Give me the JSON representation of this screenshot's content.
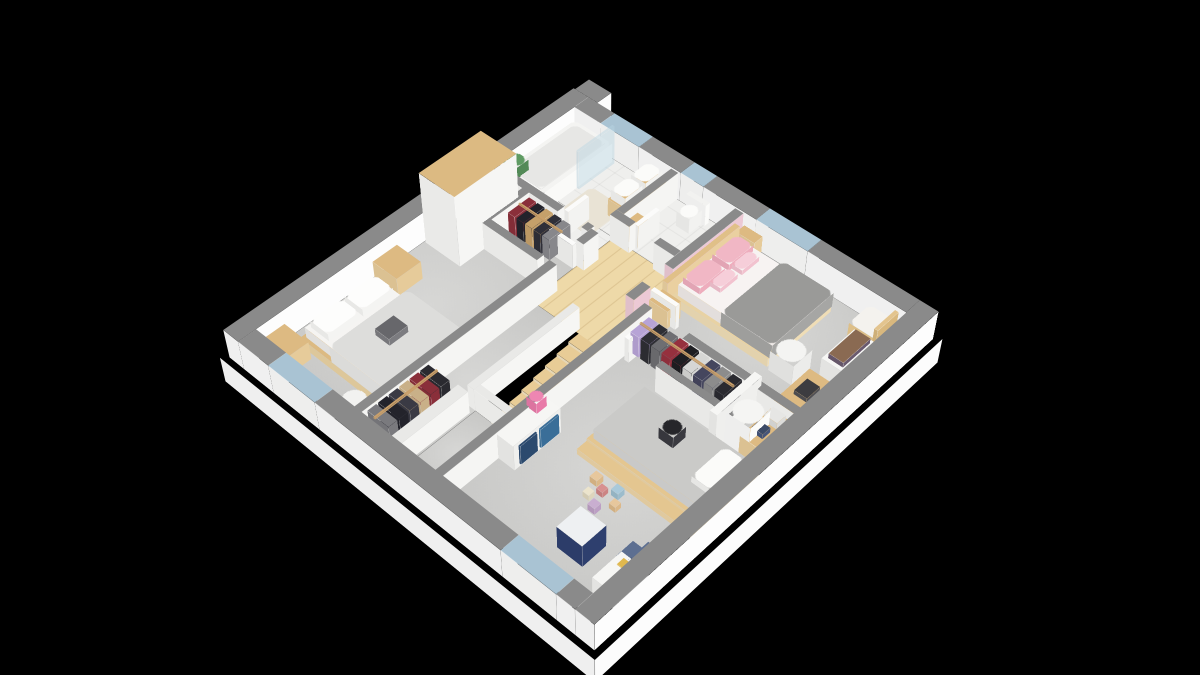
{
  "scene": {
    "background": "#000000",
    "description": "3D isometric floor plan render of a house upper storey",
    "camera": {
      "translate_x": 574,
      "translate_y": 116,
      "rotate_x_deg": 42,
      "rotate_z_deg": 43,
      "perspective_px": 1800
    },
    "palette": {
      "wall_top": "#8a8a8a",
      "wall_side": "#f5f5f3",
      "exterior_side": "#fdfdfd",
      "pink_wall": "#ecc9d5",
      "carpet": "#d2d2d0",
      "tile": "#efefed",
      "wood_floor": "#eed9a8",
      "wood_furniture": "#ddba82",
      "window_glass": "#a9c3d3",
      "gray_duvet": "#9a9a98",
      "kids_duvet": "#cacac8",
      "pink_textile": "#f1b7c5",
      "navy_toybox": "#2e3f6e",
      "blue_drawer": "#3a6e98",
      "glass": "rgba(185,212,226,0.45)"
    },
    "rooms": [
      {
        "name": "bathroom"
      },
      {
        "name": "wc"
      },
      {
        "name": "landing-with-stairs"
      },
      {
        "name": "bedroom-left"
      },
      {
        "name": "bedroom-pink"
      },
      {
        "name": "kids-bedroom"
      },
      {
        "name": "walk-in-closet-upper"
      },
      {
        "name": "walk-in-closet-lower"
      }
    ],
    "slab": [
      -6,
      -6,
      452,
      452,
      -32,
      0,
      "#fcfcfc"
    ],
    "floors": [
      [
        20,
        20,
        205,
        80,
        "tile"
      ],
      [
        20,
        100,
        126,
        30,
        "tile"
      ],
      [
        146,
        100,
        98,
        110,
        "wood"
      ],
      [
        20,
        130,
        126,
        290,
        "carpet"
      ],
      [
        225,
        20,
        195,
        150,
        "carpet"
      ],
      [
        244,
        170,
        176,
        250,
        "carpet"
      ],
      [
        146,
        210,
        56,
        210,
        "carpet"
      ],
      [
        202,
        335,
        42,
        85,
        "carpet"
      ]
    ],
    "walls": [
      [
        0,
        0,
        20,
        440,
        "ext"
      ],
      [
        20,
        0,
        35,
        20,
        "ext"
      ],
      [
        105,
        0,
        53,
        20,
        "ext"
      ],
      [
        186,
        0,
        64,
        20,
        "ext"
      ],
      [
        310,
        0,
        110,
        20,
        "ext"
      ],
      [
        420,
        0,
        20,
        440,
        "ext"
      ],
      [
        20,
        420,
        40,
        20,
        "ext"
      ],
      [
        120,
        420,
        220,
        20,
        "ext"
      ],
      [
        400,
        420,
        20,
        20,
        "ext"
      ],
      [
        2,
        -20,
        30,
        20,
        "ext"
      ],
      [
        55,
        0,
        50,
        20,
        "window"
      ],
      [
        158,
        0,
        28,
        20,
        "window"
      ],
      [
        250,
        0,
        60,
        20,
        "window"
      ],
      [
        60,
        420,
        60,
        20,
        "window"
      ],
      [
        340,
        420,
        60,
        20,
        "window"
      ],
      [
        20,
        126,
        88,
        9,
        "int"
      ],
      [
        138,
        126,
        8,
        9,
        "int"
      ],
      [
        146,
        20,
        9,
        76,
        "int"
      ],
      [
        146,
        96,
        24,
        9,
        "int"
      ],
      [
        200,
        96,
        25,
        9,
        "int"
      ],
      [
        146,
        130,
        9,
        20,
        "int"
      ],
      [
        146,
        185,
        9,
        235,
        "int"
      ],
      [
        244,
        166,
        9,
        254,
        "int"
      ],
      [
        296,
        166,
        124,
        9,
        "int"
      ],
      [
        300,
        206,
        84,
        8,
        "int"
      ],
      [
        62,
        130,
        9,
        60,
        "int"
      ],
      [
        62,
        184,
        76,
        9,
        "int"
      ],
      [
        225,
        20,
        10,
        98,
        "pink"
      ],
      [
        225,
        148,
        10,
        22,
        "pink"
      ],
      [
        194,
        205,
        8,
        130,
        "low"
      ],
      [
        202,
        327,
        42,
        8,
        "low"
      ],
      [
        188,
        340,
        12,
        80,
        "low"
      ],
      [
        108,
        98,
        5,
        28,
        "door"
      ],
      [
        168,
        66,
        5,
        30,
        "door"
      ],
      [
        116,
        150,
        30,
        5,
        "door"
      ],
      [
        235,
        143,
        30,
        5,
        "door"
      ],
      [
        256,
        175,
        5,
        30,
        "door"
      ]
    ],
    "stairs": {
      "x": 204,
      "y": 207,
      "width": 38,
      "step_depth": 15,
      "count": 8,
      "top_drop": 2,
      "drop_per_step": 3.6,
      "top": "#e8cc96",
      "side": "#f2e2c0"
    },
    "furniture": [
      [
        "bathtub",
        24,
        24,
        50,
        98,
        0,
        24,
        "#f4f4f2",
        "#fafaf8",
        1
      ],
      [
        "bathtub-inner",
        29,
        29,
        40,
        88,
        24,
        25,
        "#e7e7e5",
        "#e7e7e5",
        1
      ],
      [
        "shower-glass",
        74,
        24,
        3,
        50,
        0,
        48,
        "rgba(185,212,226,0.45)",
        "rgba(185,212,226,0.45)",
        0
      ],
      [
        "plant",
        24,
        106,
        18,
        16,
        20,
        38,
        "#5f9b63",
        "#538a57",
        2
      ],
      [
        "bath-mat",
        84,
        64,
        44,
        50,
        0,
        1,
        "#e9e3d5",
        "#e9e3d5",
        1
      ],
      [
        "vanity",
        122,
        24,
        22,
        58,
        0,
        22,
        "#ddba82",
        "#e6cb9a",
        0
      ],
      [
        "sink-1",
        124,
        28,
        18,
        24,
        22,
        34,
        "#fbfbf9",
        "#f3f3f1",
        1
      ],
      [
        "sink-2",
        124,
        56,
        18,
        24,
        22,
        34,
        "#fbfbf9",
        "#f3f3f1",
        1
      ],
      [
        "toilet-tank",
        174,
        24,
        24,
        6,
        0,
        26,
        "#f2f2f0",
        "#fbfbf9",
        0
      ],
      [
        "toilet-bowl",
        178,
        30,
        16,
        18,
        0,
        18,
        "#fbfbf9",
        "#f2f2f0",
        2
      ],
      [
        "wc-shelf",
        156,
        78,
        16,
        16,
        0,
        24,
        "#ddba82",
        "#e6cb9a",
        0
      ],
      [
        "wardrobe",
        22,
        146,
        46,
        78,
        0,
        88,
        "#dcba82",
        "#f6f6f4",
        0
      ],
      [
        "nightstand-1",
        22,
        258,
        32,
        30,
        0,
        22,
        "#ddba82",
        "#e6cb9a",
        0
      ],
      [
        "nightstand-2",
        22,
        392,
        32,
        30,
        0,
        22,
        "#ddba82",
        "#e6cb9a",
        0
      ],
      [
        "bed-frame",
        36,
        296,
        116,
        92,
        0,
        11,
        "#dcba82",
        "#e9d1a2",
        0
      ],
      [
        "bed-mattress",
        40,
        300,
        108,
        84,
        11,
        24,
        "#f5f4f2",
        "#ecebe9",
        0
      ],
      [
        "bed-duvet",
        78,
        296,
        72,
        92,
        11,
        32,
        "#dddddb",
        "#e6e6e4",
        1
      ],
      [
        "bed-pillow-1",
        44,
        304,
        24,
        36,
        24,
        33,
        "#fdfdfc",
        "#f4f4f2",
        1
      ],
      [
        "bed-pillow-2",
        44,
        344,
        24,
        36,
        24,
        33,
        "#fdfdfc",
        "#f4f4f2",
        1
      ],
      [
        "bed-books",
        98,
        330,
        18,
        22,
        32,
        40,
        "#67676b",
        "#7c7c80",
        0
      ],
      [
        "pouf",
        116,
        394,
        22,
        22,
        0,
        15,
        "#f2f2f0",
        "#fafaf8",
        2
      ],
      [
        "clothes-m1",
        74,
        138,
        9,
        28,
        6,
        32,
        "#8a2f3a",
        "#8a2f3a",
        0
      ],
      [
        "clothes-m2",
        85,
        138,
        9,
        28,
        6,
        32,
        "#23232b",
        "#23232b",
        0
      ],
      [
        "clothes-m3",
        96,
        138,
        9,
        28,
        6,
        32,
        "#c5a06a",
        "#c5a06a",
        0
      ],
      [
        "clothes-m4",
        107,
        138,
        9,
        28,
        6,
        32,
        "#2f2f38",
        "#2f2f38",
        0
      ],
      [
        "clothes-m5",
        118,
        138,
        9,
        28,
        6,
        32,
        "#87878b",
        "#87878b",
        0
      ],
      [
        "rail-m",
        74,
        150,
        55,
        2,
        32,
        34,
        "#caa06a",
        "#caa06a",
        0
      ],
      [
        "headboard-panel",
        235,
        32,
        6,
        100,
        0,
        30,
        "#e0c088",
        "#ead0a0",
        0
      ],
      [
        "pink-bed-frame",
        241,
        36,
        112,
        90,
        0,
        10,
        "#e8d2a4",
        "#efddb6",
        0
      ],
      [
        "pink-bed-mattress",
        245,
        40,
        104,
        82,
        10,
        24,
        "#f7f3f2",
        "#efeae8",
        0
      ],
      [
        "pink-bed-duvet",
        297,
        38,
        58,
        86,
        10,
        28,
        "#9a9a98",
        "#a6a6a4",
        1
      ],
      [
        "pink-pillow-1",
        247,
        44,
        20,
        34,
        24,
        32,
        "#f1b7c5",
        "#eeadbd",
        1
      ],
      [
        "pink-pillow-2",
        247,
        84,
        20,
        34,
        24,
        32,
        "#f1b7c5",
        "#eeadbd",
        1
      ],
      [
        "pink-cushion-1",
        267,
        50,
        12,
        24,
        24,
        30,
        "#f6ced9",
        "#f2c2cf",
        1
      ],
      [
        "pink-cushion-2",
        267,
        80,
        12,
        24,
        24,
        30,
        "#f6ced9",
        "#f2c2cf",
        1
      ],
      [
        "bedside-shelf-1",
        237,
        16,
        22,
        16,
        0,
        20,
        "#ddba82",
        "#e6cb9a",
        0
      ],
      [
        "bedside-shelf-2",
        237,
        134,
        22,
        18,
        0,
        22,
        "#ddba82",
        "#e6cb9a",
        0
      ],
      [
        "chair-seat",
        386,
        26,
        30,
        30,
        0,
        26,
        "#f4f2ee",
        "#e9c98f",
        1
      ],
      [
        "chair-back",
        412,
        26,
        4,
        30,
        0,
        38,
        "#e3c48e",
        "#d9b87e",
        0
      ],
      [
        "stool",
        356,
        102,
        26,
        26,
        0,
        25,
        "#f4f4f2",
        "#ececea",
        2
      ],
      [
        "bookshelf",
        396,
        62,
        26,
        46,
        0,
        30,
        "#f6f6f4",
        "#efefed",
        0
      ],
      [
        "books",
        400,
        66,
        16,
        38,
        30,
        36,
        "#8a6a52",
        "#6a5a6e",
        0
      ],
      [
        "desk",
        392,
        118,
        30,
        52,
        0,
        22,
        "#ddba82",
        "#e6cb9a",
        0
      ],
      [
        "laptop",
        400,
        132,
        14,
        18,
        22,
        27,
        "#3c3c40",
        "#505054",
        0
      ],
      [
        "clothes-k1",
        258,
        176,
        10,
        24,
        8,
        34,
        "#b7a3d6",
        "#b7a3d6",
        0
      ],
      [
        "clothes-k2",
        270,
        176,
        10,
        24,
        8,
        34,
        "#2e2e34",
        "#2e2e34",
        0
      ],
      [
        "clothes-k3",
        282,
        176,
        10,
        24,
        8,
        34,
        "#6e6e72",
        "#6e6e72",
        0
      ],
      [
        "clothes-k4",
        294,
        176,
        10,
        24,
        8,
        34,
        "#96303e",
        "#96303e",
        0
      ],
      [
        "clothes-k5",
        306,
        176,
        10,
        24,
        8,
        34,
        "#1e1e22",
        "#1e1e22",
        0
      ],
      [
        "clothes-k6",
        318,
        176,
        10,
        24,
        8,
        34,
        "#d6d6d4",
        "#d6d6d4",
        0
      ],
      [
        "clothes-k7",
        330,
        176,
        10,
        24,
        8,
        34,
        "#45465e",
        "#45465e",
        0
      ],
      [
        "clothes-k8",
        342,
        176,
        10,
        24,
        8,
        34,
        "#8c8c8c",
        "#8c8c8c",
        0
      ],
      [
        "clothes-k9",
        354,
        176,
        10,
        24,
        8,
        34,
        "#2a2a30",
        "#2a2a30",
        0
      ],
      [
        "rail-k",
        258,
        186,
        106,
        2,
        34,
        36,
        "#caa06a",
        "#caa06a",
        0
      ],
      [
        "closet-divider",
        372,
        170,
        8,
        58,
        0,
        46,
        "#f6f6f4",
        "#efefed",
        0
      ],
      [
        "laundry-bin",
        380,
        190,
        26,
        26,
        0,
        40,
        "#f5f5f3",
        "#fbfbf9",
        2
      ],
      [
        "kids-corner-desk",
        396,
        172,
        26,
        44,
        0,
        22,
        "#ddba82",
        "#e6cb9a",
        0
      ],
      [
        "kids-printer",
        400,
        178,
        14,
        12,
        22,
        30,
        "#e6e6e4",
        "#dcdcda",
        0
      ],
      [
        "kids-blue-box",
        400,
        196,
        12,
        10,
        22,
        28,
        "#3c4a66",
        "#46557a",
        0
      ],
      [
        "kids-bed-frame",
        298,
        226,
        128,
        72,
        0,
        10,
        "#e4c690",
        "#ecd4a6",
        0
      ],
      [
        "kids-bed-mattress",
        302,
        230,
        116,
        64,
        10,
        22,
        "#cacac8",
        "#d4d4d2",
        0
      ],
      [
        "kids-bed-pillow",
        398,
        238,
        22,
        42,
        22,
        30,
        "#fbfbf9",
        "#f2f2f0",
        1
      ],
      [
        "penguin-plush",
        348,
        248,
        16,
        16,
        22,
        36,
        "#26262a",
        "#3a3a40",
        2
      ],
      [
        "kids-bed-step",
        298,
        298,
        128,
        12,
        0,
        7,
        "#e4c690",
        "#ecd4a6",
        0
      ],
      [
        "kids-dresser",
        246,
        302,
        26,
        56,
        0,
        32,
        "#f6f6f4",
        "#efefed",
        0
      ],
      [
        "dresser-drawer-1",
        272,
        306,
        2,
        22,
        4,
        28,
        "#3a6e98",
        "#3a6e98",
        0
      ],
      [
        "dresser-drawer-2",
        272,
        332,
        2,
        20,
        4,
        28,
        "#2c4a6e",
        "#2c4a6e",
        0
      ],
      [
        "pink-lamp",
        250,
        308,
        12,
        12,
        32,
        45,
        "#ee86b2",
        "#e87aa8",
        2
      ],
      [
        "toy-block-1",
        326,
        316,
        8,
        8,
        0,
        8,
        "#e7c79c",
        "#dcb888",
        0
      ],
      [
        "toy-block-2",
        338,
        322,
        7,
        7,
        0,
        7,
        "#d89090",
        "#cc8484",
        0
      ],
      [
        "toy-block-3",
        348,
        314,
        8,
        8,
        0,
        8,
        "#a9c9da",
        "#9cbccc",
        0
      ],
      [
        "toy-block-4",
        332,
        332,
        7,
        7,
        0,
        7,
        "#ece4cc",
        "#ded6bc",
        0
      ],
      [
        "toy-block-5",
        344,
        338,
        8,
        8,
        0,
        8,
        "#c9aed0",
        "#bc9fc4",
        0
      ],
      [
        "toy-block-6",
        356,
        326,
        7,
        7,
        0,
        7,
        "#e7c79c",
        "#dcb888",
        0
      ],
      [
        "toy-cube",
        352,
        362,
        28,
        28,
        0,
        28,
        "#eef0f2",
        "#2e3f6e",
        0
      ],
      [
        "kids-chair-seat",
        398,
        350,
        20,
        20,
        0,
        12,
        "#5d6f91",
        "#516383",
        0
      ],
      [
        "kids-chair-back",
        414,
        350,
        4,
        20,
        0,
        26,
        "#5d6f91",
        "#516383",
        0
      ],
      [
        "kids-desk",
        402,
        368,
        28,
        34,
        0,
        20,
        "#f6f6f4",
        "#efefed",
        0
      ],
      [
        "paper-1",
        408,
        372,
        10,
        8,
        20,
        21,
        "#e0b84e",
        "#e0b84e",
        0
      ],
      [
        "paper-2",
        418,
        380,
        8,
        8,
        20,
        21,
        "#cc5555",
        "#cc5555",
        0
      ],
      [
        "clothes-b1",
        156,
        344,
        26,
        10,
        6,
        32,
        "#2a2a30",
        "#2a2a30",
        0
      ],
      [
        "clothes-b2",
        156,
        356,
        26,
        10,
        6,
        32,
        "#8a2f3a",
        "#8a2f3a",
        0
      ],
      [
        "clothes-b3",
        156,
        368,
        26,
        10,
        6,
        32,
        "#c9b088",
        "#c9b088",
        0
      ],
      [
        "clothes-b4",
        156,
        380,
        26,
        10,
        6,
        32,
        "#3a3a44",
        "#3a3a44",
        0
      ],
      [
        "clothes-b5",
        156,
        392,
        26,
        10,
        6,
        32,
        "#23232b",
        "#23232b",
        0
      ],
      [
        "clothes-b6",
        156,
        404,
        26,
        10,
        6,
        32,
        "#7a7a7e",
        "#7a7a7e",
        0
      ],
      [
        "rail-b",
        166,
        344,
        2,
        72,
        32,
        34,
        "#caa06a",
        "#caa06a",
        0
      ]
    ],
    "wall_types": {
      "ext": {
        "top": "#8a8a8a",
        "side": "#fdfdfd",
        "h": 36
      },
      "int": {
        "top": "#8a8a8a",
        "side": "#f5f5f3",
        "h": 34
      },
      "pink": {
        "top": "#8a8a8a",
        "side": "#ecc9d5",
        "h": 34
      },
      "low": {
        "top": "#e9e9e7",
        "side": "#f6f6f4",
        "h": 28
      },
      "window": {
        "top": "#a9c3d3",
        "side": "#fbfbf9",
        "h": 36
      },
      "door": {
        "top": "#fbfbfa",
        "side": "#f3f3f1",
        "h": 30
      }
    }
  }
}
